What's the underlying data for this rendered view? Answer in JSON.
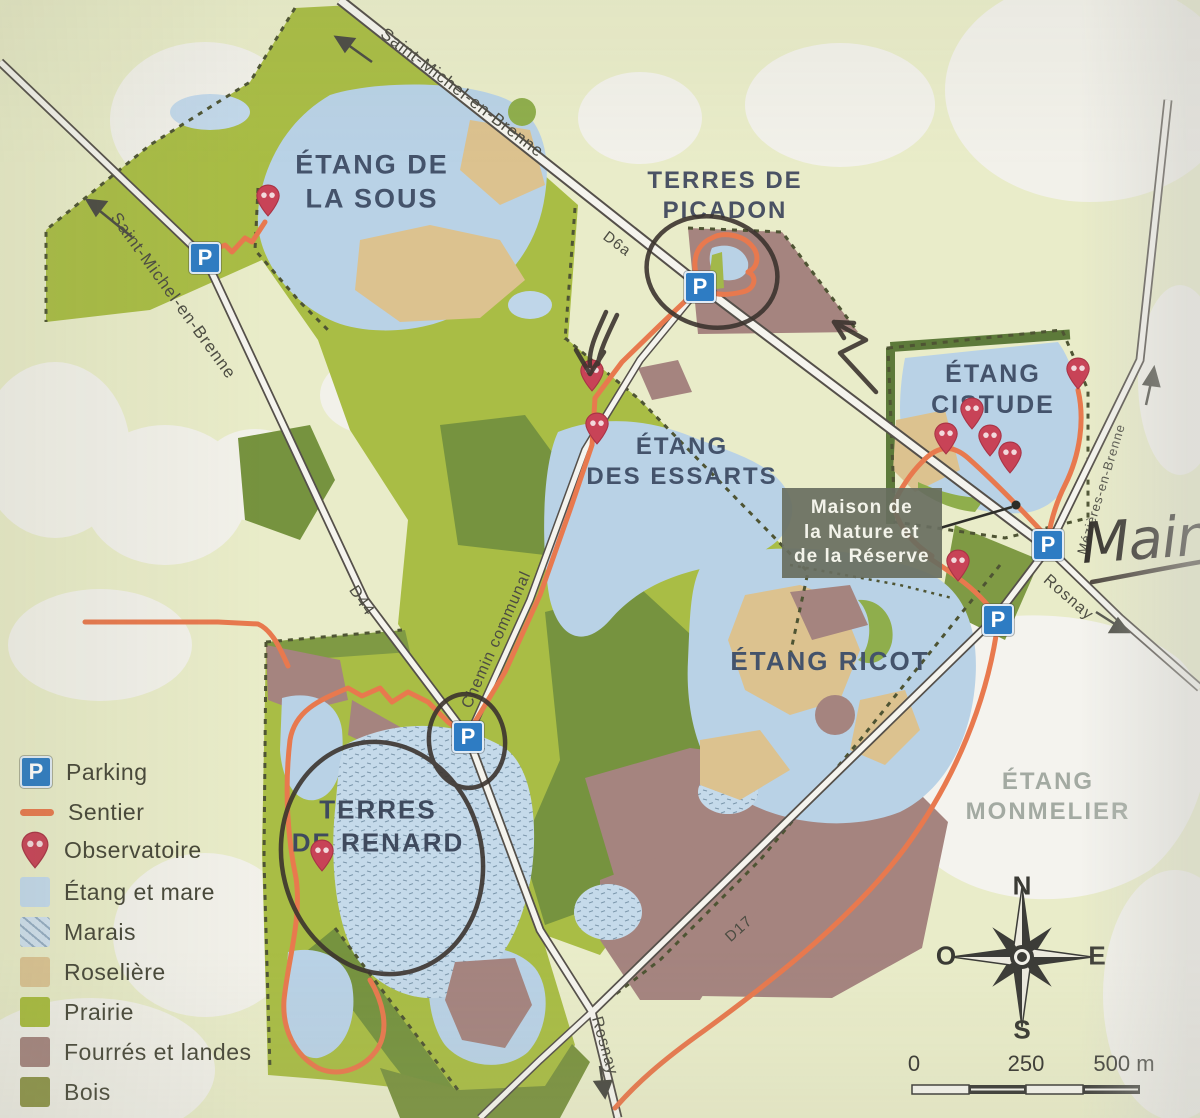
{
  "areas": {
    "sous": "ÉTANG DE\nLA SOUS",
    "picadon": "TERRES DE\nPICADON",
    "cistude": "ÉTANG\nCISTUDE",
    "essarts": "ÉTANG\nDES ESSARTS",
    "ricot": "ÉTANG RICOT",
    "renard": "TERRES\nDE RENARD",
    "monmelier": "ÉTANG\nMONMELIER",
    "maison": "Maison de\nla Nature et\nde la Réserve"
  },
  "roads": {
    "st_michel_top": "Saint-Michel-en-Brenne",
    "st_michel_left": "Saint-Michel-en-Brenne",
    "d6a": "D6a",
    "d44": "D44",
    "chemin": "Chemin communal",
    "mezieres": "Mézières-en-Brenne",
    "rosnay_right": "Rosnay",
    "d17": "D17",
    "rosnay_bottom": "Rosnay"
  },
  "legend": {
    "items": [
      {
        "icon": "parking",
        "label": "Parking"
      },
      {
        "icon": "sentier",
        "label": "Sentier"
      },
      {
        "icon": "observatoire",
        "label": "Observatoire"
      },
      {
        "icon": "etang-et-mare",
        "label": "Étang et mare"
      },
      {
        "icon": "marais",
        "label": "Marais"
      },
      {
        "icon": "roseliere",
        "label": "Roselière"
      },
      {
        "icon": "prairie",
        "label": "Prairie"
      },
      {
        "icon": "fourres-et-landes",
        "label": "Fourrés et landes"
      },
      {
        "icon": "bois",
        "label": "Bois"
      }
    ]
  },
  "compass": {
    "north": "N",
    "south": "S",
    "east": "E",
    "west": "O"
  },
  "scale_bar": {
    "start": "0",
    "middle": "250",
    "end": "500 m"
  },
  "annotations": {
    "handwritten": "Main"
  },
  "icons": {
    "parking_letter": "P"
  },
  "colors": {
    "paper": "#e9ecc9",
    "water": "#b9d2e6",
    "prairie": "#a9bd45",
    "bois": "#76933f",
    "fourres": "#a5847f",
    "roseliere": "#dcc28f",
    "sentier": "#e8794e",
    "parking_blue": "#2e7cc3",
    "observatory_red": "#c84357",
    "label_blue": "#44536b",
    "ink": "#3b342e"
  }
}
